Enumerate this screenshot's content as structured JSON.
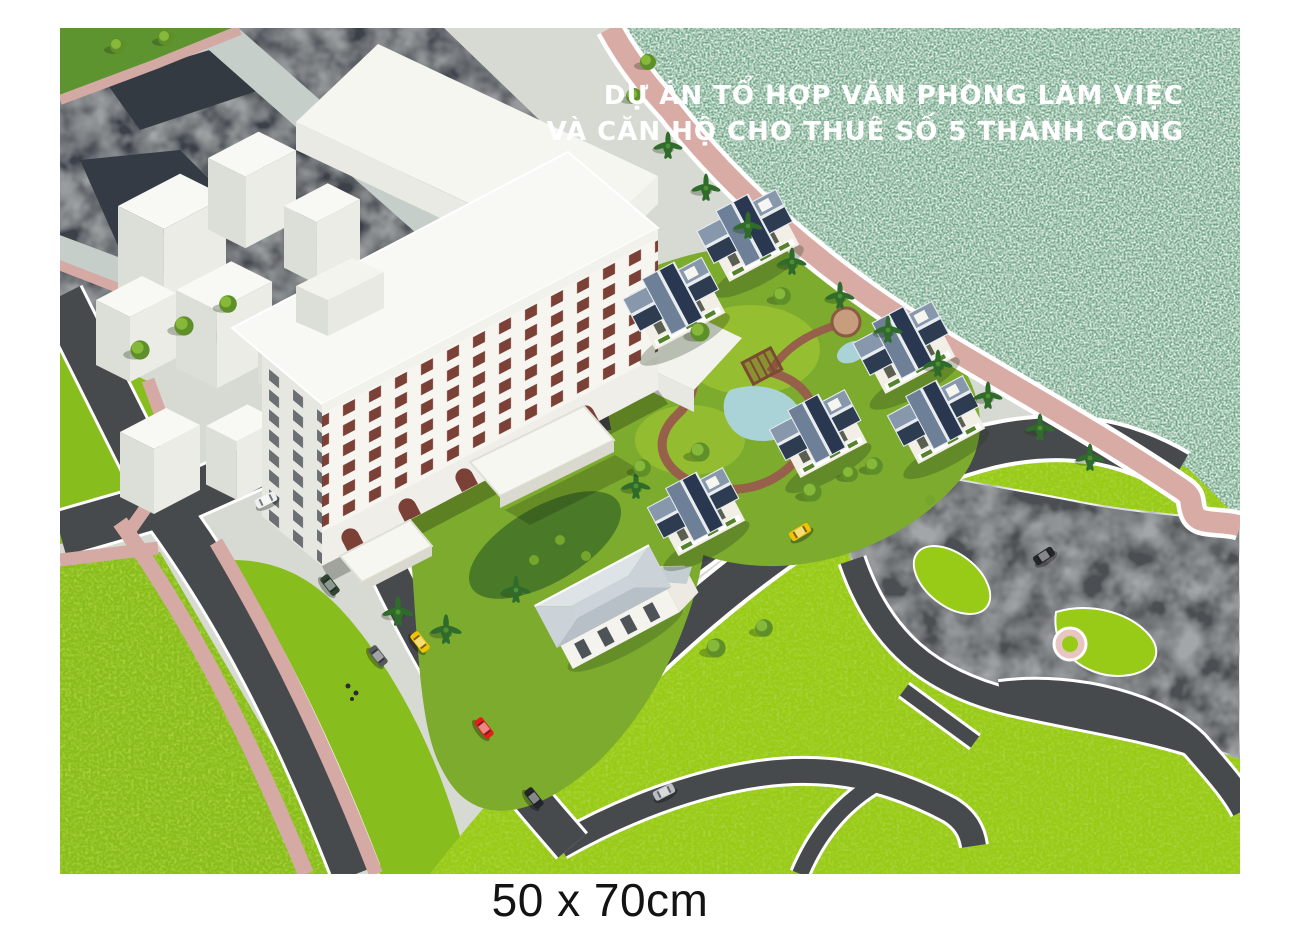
{
  "poster": {
    "title": {
      "line1": "DỰ ÁN TỔ HỢP VĂN PHÒNG LÀM VIỆC",
      "line2": "VÀ CĂN HỘ CHO THUÊ SỐ 5 THÀNH CÔNG"
    },
    "size_caption": "50 x 70cm"
  },
  "scene": {
    "type": "aerial architectural rendering",
    "elements": {
      "lake": "textured teal water, upper right",
      "office_building": "white 9-storey office block with maroon windows and entrance canopies",
      "blue_roof_villas": 6,
      "gray_roof_clubhouse": 1,
      "white_massing_blocks": 9,
      "park": "lime green park with dark curved paths, lower right",
      "cars": [
        "yellow-taxi",
        "yellow-taxi-2",
        "red-car",
        "white-car",
        "silver-car",
        "green-car",
        "black-car",
        "black-car-2",
        "gray-car"
      ]
    }
  },
  "colors": {
    "background": "#ffffff",
    "ground": "#d7dad2",
    "water": "#73a78b",
    "city_block": "#3a4148",
    "road_light": "#c6cec9",
    "road_dark": "#474a4d",
    "curb": "#ffffff",
    "sidewalk": "#d5a9a4",
    "promenade": "#d9aba5",
    "lawn": "#88bd1e",
    "park_grass": "#98cb17",
    "garden_green": "#7cab2e",
    "foliage_dark": "#3f7026",
    "building_white": "#f6f5f0",
    "window_maroon": "#7b4136",
    "villa_roof_light": "#8798ad",
    "villa_roof_dark": "#2e3c52",
    "clubhouse_roof": "#ccd4d9",
    "path_brown": "#96604a",
    "pond": "#a9d3d6",
    "pergola": "#7b4a33",
    "plaza_circle": "#e7c6c1",
    "car_yellow": "#f2c200",
    "car_red": "#e51e1a",
    "car_white": "#eef0f0",
    "car_silver": "#b9bec2",
    "car_black": "#232628",
    "car_green": "#2f4431",
    "title_text": "#ffffff",
    "caption_text": "#131313"
  }
}
